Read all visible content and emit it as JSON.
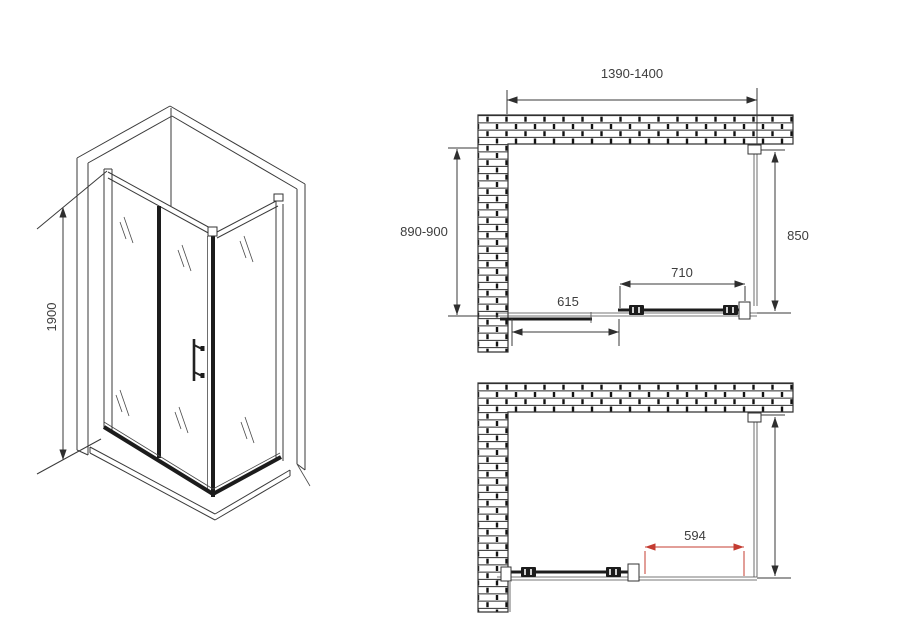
{
  "colors": {
    "background": "#ffffff",
    "line": "#3a3a3a",
    "text": "#3d3d3d",
    "red_dimension": "#c43c32"
  },
  "isometric_view": {
    "height_label": "1900"
  },
  "top_plan_view": {
    "width_label": "1390-1400",
    "depth_label": "890-900",
    "side_panel_label": "850",
    "door_label": "710",
    "fixed_panel_label": "615"
  },
  "bottom_plan_view": {
    "opening_label": "594"
  }
}
